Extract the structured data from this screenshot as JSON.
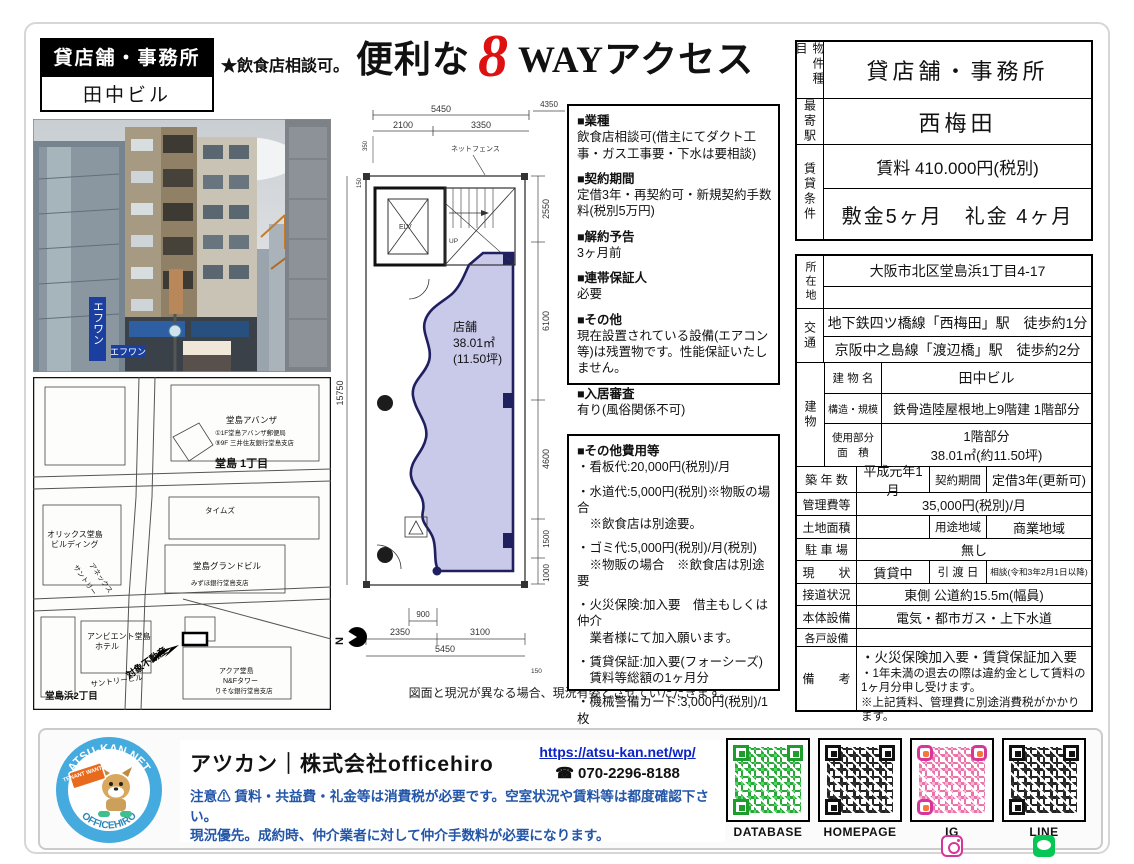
{
  "colors": {
    "accent_red": "#dd1111",
    "plan_fill": "#c9c9ea",
    "notice_blue": "#2356a8",
    "link_blue": "#0b23c4",
    "qr_green": "#1f9d2c",
    "qr_black": "#111111",
    "ig_pink": "#d6359c",
    "line_green": "#06c755",
    "logo_blue": "#45aadd"
  },
  "header": {
    "badge": "貸店舗・事務所",
    "building_name": "田中ビル",
    "note": "★飲食店相談可。",
    "catch_pre": "便利な",
    "catch_number": "8",
    "catch_post": "WAYアクセス"
  },
  "photo": {
    "sign_vertical": "エフワン",
    "sign_horizontal": "エフワン"
  },
  "map": {
    "labels": [
      "堂島 1丁目",
      "堂島アバンザ",
      "①1F堂島アバンザ郵便局",
      "⑨9F 三井住友銀行堂島支店",
      "オリックス堂島",
      "ビルディング",
      "サントリー",
      "アネックス",
      "タイムズ",
      "堂島グランドビル",
      "みずほ銀行堂島支店",
      "アンビエント堂島",
      "ホテル",
      "サントリービル",
      "堂島浜2丁目",
      "アクア堂島",
      "N&Fタワー",
      "りそな銀行堂島支店",
      "対象不動産"
    ]
  },
  "floorplan": {
    "dims": {
      "top_total": "5450",
      "top_seg1": "2100",
      "top_seg2": "3350",
      "top_right": "4350",
      "left_small1": "350",
      "left_small2": "150",
      "left_total": "15750",
      "right_1": "2550",
      "right_2": "6100",
      "right_3": "4600",
      "right_4": "1500",
      "right_5": "1000",
      "bottom_small": "900",
      "bottom_seg1": "2350",
      "bottom_seg2": "3100",
      "bottom_total": "5450",
      "bottom_tiny": "150"
    },
    "labels": {
      "fence": "ネットフェンス",
      "elevator": "ELV",
      "stairs": "UP",
      "shop_line1": "店舗",
      "shop_line2": "38.01㎡",
      "shop_line3": "(11.50坪)",
      "north": "N"
    },
    "disclaimer": "図面と現況が異なる場合、現況有姿とさせていただきます。"
  },
  "notes1": {
    "sections": [
      {
        "title": "■業種",
        "body": "飲食店相談可(借主にてダクト工事・ガス工事要・下水は要相談)"
      },
      {
        "title": "■契約期間",
        "body": "定借3年・再契約可・新規契約手数料(税別5万円)"
      },
      {
        "title": "■解約予告",
        "body": "3ヶ月前"
      },
      {
        "title": "■連帯保証人",
        "body": "必要"
      },
      {
        "title": "■その他",
        "body": "現在設置されている設備(エアコン等)は残置物です。性能保証いたしません。"
      },
      {
        "title": "■入居審査",
        "body": "有り(風俗関係不可)"
      }
    ]
  },
  "notes2": {
    "title": "■その他費用等",
    "items": [
      "・看板代:20,000円(税別)/月",
      "・水道代:5,000円(税別)※物販の場合\n　※飲食店は別途要。",
      "・ゴミ代:5,000円(税別)/月(税別)\n　※物販の場合　※飲食店は別途要",
      "・火災保険:加入要　借主もしくは仲介\n　業者様にて加入願います。",
      "・賃貸保証:加入要(フォーシーズ)\n　賃料等総額の1ヶ月分",
      "・機械警備カード:3,000円(税別)/1枚"
    ]
  },
  "summary_table": {
    "type_label": "物件種目",
    "type": "貸店舗・事務所",
    "station_label": "最寄駅",
    "station": "西梅田",
    "terms_label": "賃貸条件",
    "rent": "賃料 410.000円(税別)",
    "deposit": "敷金5ヶ月　礼金 4ヶ月"
  },
  "detail_table": {
    "location_label": "所在地",
    "location": "大阪市北区堂島浜1丁目4-17",
    "location2": "",
    "access_label": "交通",
    "access1": "地下鉄四ツ橋線「西梅田」駅　徒歩約1分",
    "access2": "京阪中之島線「渡辺橋」駅　徒歩約2分",
    "building_label": "建物",
    "bname_label": "建 物 名",
    "bname": "田中ビル",
    "structure_label": "構造・規模",
    "structure": "鉄骨造陸屋根地上9階建 1階部分",
    "area_label": "使用部分\n面　積",
    "area1": "1階部分",
    "area2": "38.01㎡(約11.50坪)",
    "built_label": "築 年 数",
    "built": "平成元年1月",
    "contract_label": "契約期間",
    "contract": "定借3年(更新可)",
    "fee_label": "管理費等",
    "fee": "35,000円(税別)/月",
    "land_label": "土地面積",
    "land": "",
    "zone_label": "用途地域",
    "zone": "商業地域",
    "parking_label": "駐 車 場",
    "parking": "無し",
    "status_label": "現　　状",
    "status": "賃貸中",
    "handover_label": "引 渡 日",
    "handover": "相談(令和3年2月1日以降)",
    "road_label": "接道状況",
    "road": "東側 公道約15.5m(幅員)",
    "facility_label": "本体設備",
    "facility": "電気・都市ガス・上下水道",
    "unit_label": "各戸設備",
    "unit": "",
    "remarks_label": "備　　考",
    "remarks1": "・火災保険加入要・賃貸保証加入要",
    "remarks2": "・1年未満の退去の際は違約金として賃料の1ヶ月分申し受けます。",
    "remarks3": "※上記賃料、管理費に別途消費税がかかります。"
  },
  "footer": {
    "logo_top": "ATSU-KAN.NET",
    "logo_bottom": "OFFICEHIRO",
    "logo_tag": "TENANT WANTED",
    "company": "アツカン｜株式会社officehiro",
    "url": "https://atsu-kan.net/wp/",
    "phone_icon": "☎",
    "phone": "070-2296-8188",
    "notice1": "注意⚠ 賃料・共益費・礼金等は消費税が必要です。空室状況や賃料等は都度確認下さい。",
    "notice2": "現況優先。成約時、仲介業者に対して仲介手数料が必要になります。",
    "qr": [
      {
        "label": "DATABASE"
      },
      {
        "label": "HOMEPAGE"
      },
      {
        "label": "IG"
      },
      {
        "label": "LINE"
      }
    ]
  }
}
